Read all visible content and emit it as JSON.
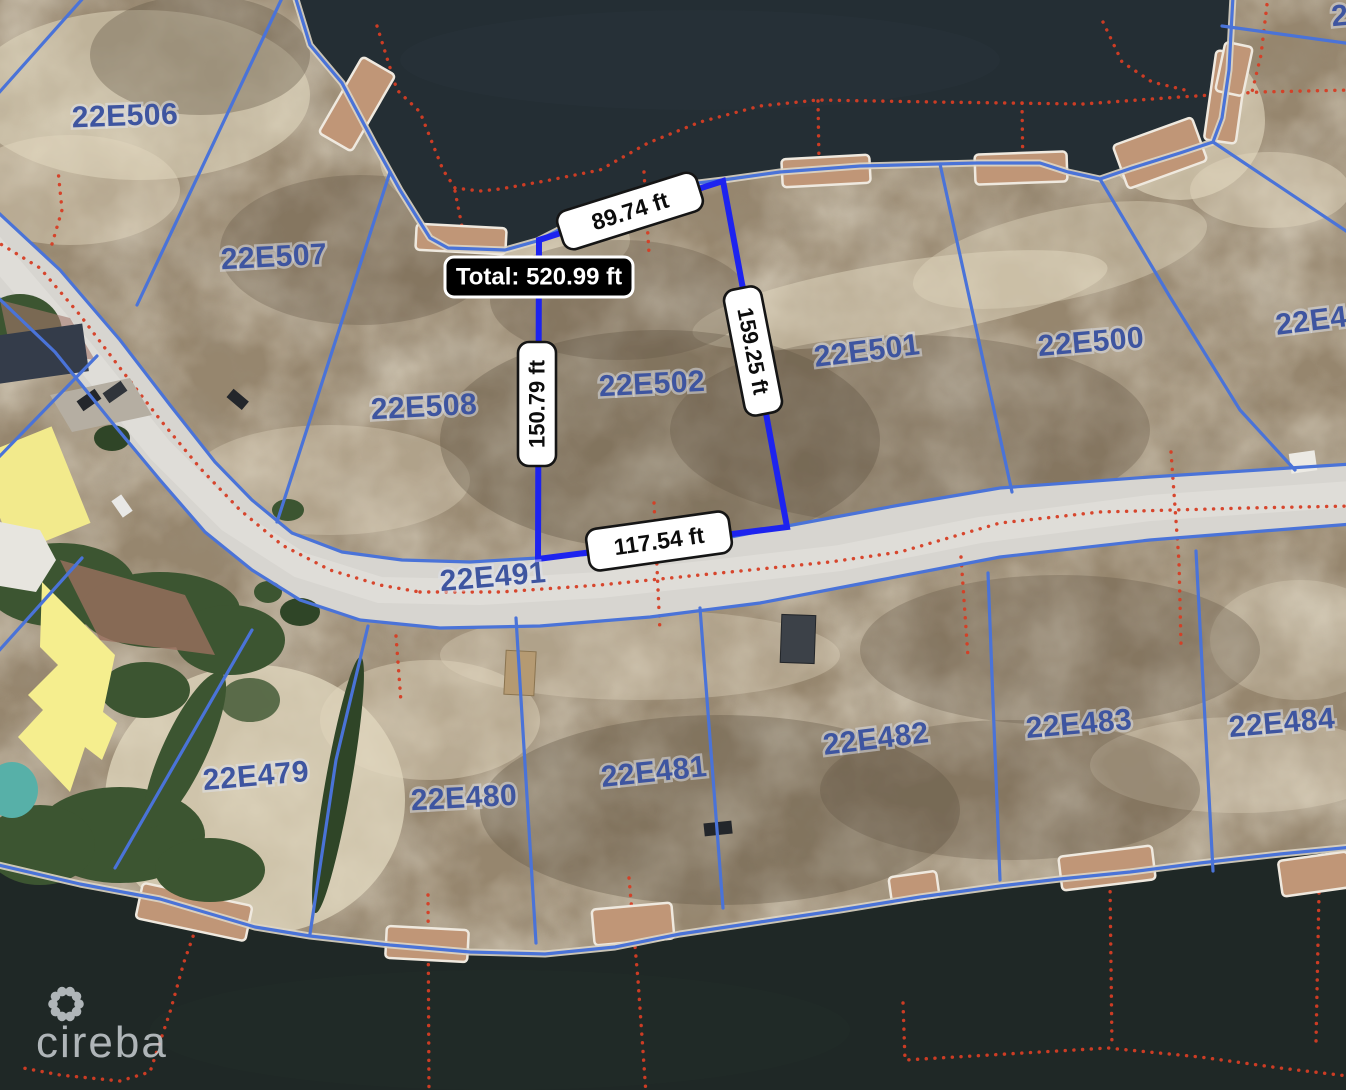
{
  "map": {
    "parcels": [
      {
        "label": "22E506"
      },
      {
        "label": "22E507"
      },
      {
        "label": "22E508"
      },
      {
        "label": "22E502"
      },
      {
        "label": "22E501"
      },
      {
        "label": "22E500"
      },
      {
        "label": "22E49"
      },
      {
        "label": "22E479"
      },
      {
        "label": "22E480"
      },
      {
        "label": "22E481"
      },
      {
        "label": "22E482"
      },
      {
        "label": "22E483"
      },
      {
        "label": "22E484"
      }
    ],
    "road_label": "22E491",
    "partial_label_top_right": "2",
    "measurement": {
      "total": "Total: 520.99 ft",
      "sides": [
        {
          "label": "89.74 ft"
        },
        {
          "label": "159.25 ft"
        },
        {
          "label": "117.54 ft"
        },
        {
          "label": "150.79 ft"
        }
      ]
    },
    "watermark": "cireba",
    "colors": {
      "line-blue": "#4a73d8",
      "measure-blue": "#1d23ef",
      "label-blue": "#3e55a0",
      "dot-red": "#d63d24",
      "badge-bg": "#ffffff",
      "badge-border": "#151515",
      "total-bg": "#000000",
      "total-text": "#ffffff",
      "watermark": "#c9ced2"
    }
  }
}
